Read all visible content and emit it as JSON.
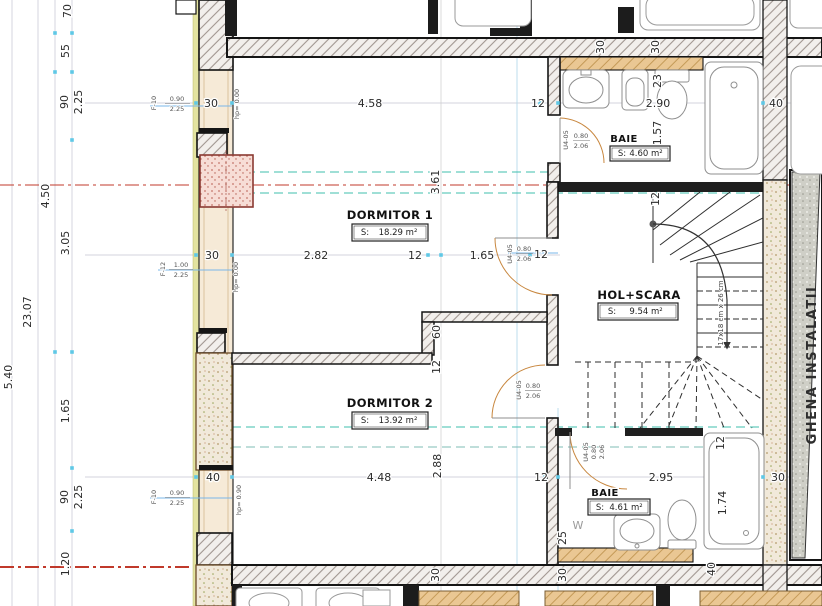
{
  "rooms": {
    "dormitor1": {
      "name": "DORMITOR 1",
      "s": "S:",
      "area": "18.29 m²"
    },
    "dormitor2": {
      "name": "DORMITOR 2",
      "s": "S:",
      "area": "13.92 m²"
    },
    "baie_top": {
      "name": "BAIE",
      "s": "S:",
      "area": "4.60 m²"
    },
    "baie_bottom": {
      "name": "BAIE",
      "s": "S:",
      "area": "4.61 m²"
    },
    "hol_scara": {
      "name": "HOL+SCARA",
      "s": "S:",
      "area": "9.54 m²"
    },
    "ghena": {
      "name": "GHENA INSTALATII"
    }
  },
  "dims": {
    "left": {
      "v70": "70",
      "v55": "55",
      "v90a": "90",
      "v225a": "2.25",
      "v450": "4.50",
      "v305": "3.05",
      "v2307": "23.07",
      "v540": "5.40",
      "v165": "1.65",
      "v90b": "90",
      "v225b": "2.25",
      "v120": "1.20"
    },
    "top": {
      "w30": "30",
      "a458": "4.58",
      "a12": "12",
      "a290": "2.90",
      "a40": "40",
      "t30a": "30",
      "t30b": "30",
      "v23": "23",
      "v157": "1.57"
    },
    "mid": {
      "w30": "30",
      "a282": "2.82",
      "a12": "12",
      "a165": "1.65",
      "d12": "12",
      "v361": "3.61"
    },
    "inner": {
      "v60": "60",
      "v12": "12",
      "stair12": "12"
    },
    "bottom": {
      "w40": "40",
      "a448": "4.48",
      "v288": "2.88",
      "a12": "12",
      "a295": "2.95",
      "r30": "30",
      "v174": "1.74",
      "v12": "12",
      "v25": "25",
      "v40": "40",
      "b30a": "30",
      "b30b": "30",
      "w": "W"
    }
  },
  "markers": {
    "f10": "F-10",
    "f12": "F-12",
    "f10_w": "0.90",
    "f10_h": "2.25",
    "f12_w": "1.00",
    "f12_h": "2.25",
    "hp0": "hp= 0.00",
    "hp90": "hp= 0.90",
    "door_code": "U4-05",
    "door_w": "0.80",
    "door_h": "2.06",
    "stair_note": "17x18 cm x 26 cm"
  },
  "colors": {
    "centerline_red": "#c0392b",
    "axis_teal": "#3fbfae",
    "guide_blue": "#a9d7ec",
    "wall_dark": "#1c1c1c",
    "wood": "#eac793",
    "column_pink": "#f3d3ca"
  }
}
